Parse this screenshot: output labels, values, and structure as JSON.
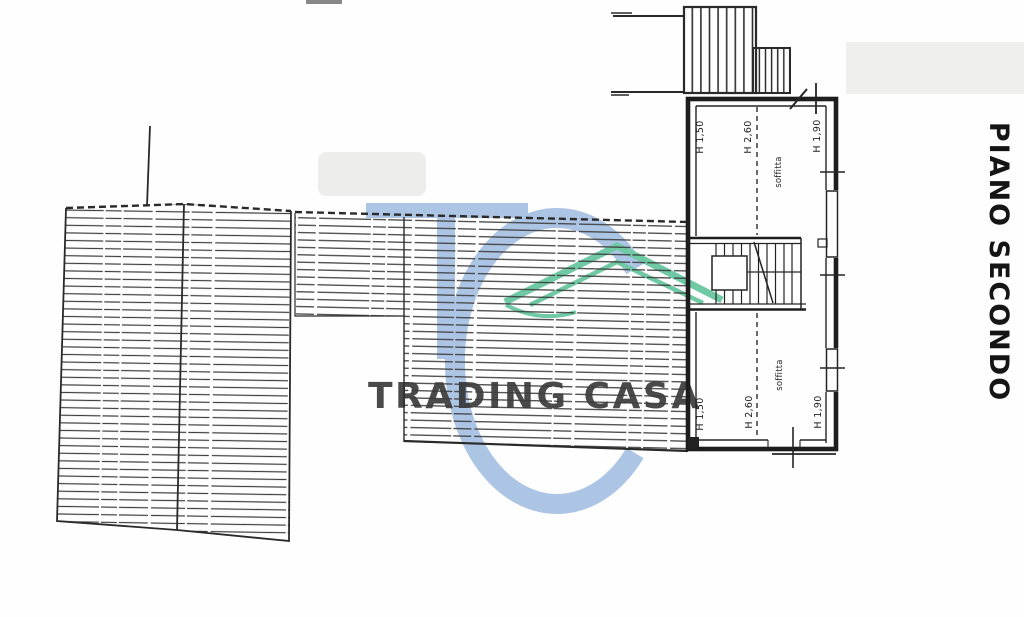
{
  "title": {
    "label": "PIANO SECONDO"
  },
  "watermark": {
    "monogram": "TC",
    "text": "TRADING CASA",
    "blue": "#a9c2e3",
    "green": "#69c7a1"
  },
  "plan": {
    "rooms": [
      {
        "name": "soffitta",
        "h_left": "H 1,50",
        "h_mid": "H 2,60",
        "h_right": "H 1,90"
      },
      {
        "name": "soffitta",
        "h_left": "H 1,50",
        "h_mid": "H 2,60",
        "h_right": "H 1,90"
      }
    ]
  },
  "colors": {
    "ink": "#2b2b2b",
    "hatch": "#3c3c3c",
    "paper": "#fefefe"
  }
}
